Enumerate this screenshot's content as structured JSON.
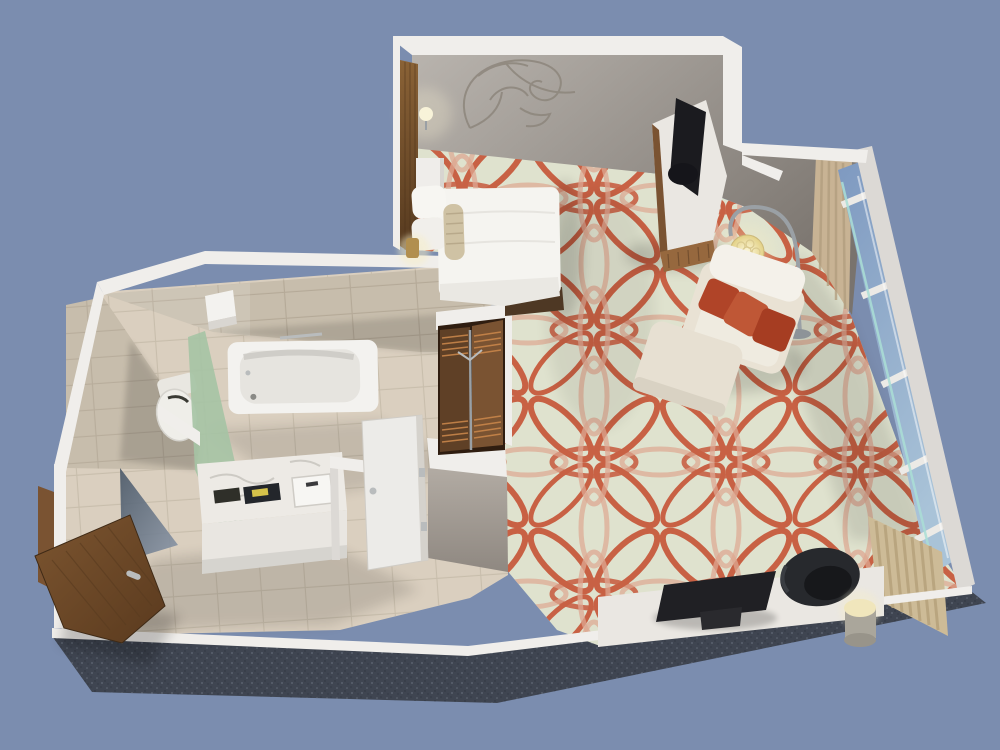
{
  "scene": {
    "type": "3d-room-render",
    "description": "Isometric cutaway 3D rendering of a hotel guest room floor plan on a plain blue background",
    "rooms": {
      "bedroom": {
        "objects": [
          "wall-art-swirl",
          "king-bed",
          "pillows",
          "bolster-cushion",
          "headboard-panel",
          "wall-sconce",
          "nightstand",
          "table-lamp-brass",
          "tv-console",
          "flat-screen-tv",
          "arc-floor-lamp",
          "armchair",
          "throw-pillows",
          "ottoman",
          "patterned-carpet",
          "work-desk",
          "desktop-monitor",
          "office-chair",
          "cylinder-table-lamp",
          "curtain",
          "floor-to-ceiling-windows",
          "vertical-blinds"
        ]
      },
      "bathroom": {
        "objects": [
          "tile-walls",
          "tile-floor",
          "bathtub",
          "towel-bar",
          "towel-shelf",
          "shower-glass-panel",
          "shower-head",
          "toilet",
          "wc-nook",
          "vanity-counter",
          "sink",
          "faucet",
          "amenity-trays",
          "closet",
          "louvered-doors",
          "bathroom-door-white",
          "entry-door-wood",
          "door-frame",
          "entry-mirror"
        ]
      },
      "structure": {
        "objects": [
          "exterior-white-walls",
          "foundation-slab",
          "sky-background"
        ]
      }
    }
  },
  "colors": {
    "background": "#7b8daf",
    "foundation": "#3f4551",
    "foundation_speck_light": "#69727f",
    "foundation_speck_dark": "#2b3039",
    "wall_white": "#f0eeeb",
    "wall_white_shade": "#dcd9d5",
    "wall_face_light": "#b9b4ae",
    "wall_face_dark": "#79736d",
    "wall_face_mid": "#a49d96",
    "art_stroke": "#8d867c",
    "carpet_base": "#dfe2ce",
    "carpet_primary": "#c75a3d",
    "carpet_secondary": "#dda48e",
    "tile_wall": "#c7bdac",
    "tile_wall_line": "#b3a896",
    "tile_floor": "#dacfbf",
    "tile_floor_line": "#c6bba9",
    "wood_dark": "#5f4026",
    "wood_mid": "#7a5332",
    "wood_light": "#96683e",
    "closet_interior": "#2f1d10",
    "louver_slat": "#c8854a",
    "glass_green": "#a5c3a4",
    "glass_blue_deep": "#7e99c0",
    "glass_blue_light": "#a9c3d8",
    "glass_teal": "#abdfd6",
    "curtain": "#c8b394",
    "curtain_fold": "#b29d7e",
    "blinds": "#cdbb97",
    "blinds_line": "#b7a37d",
    "fixture_white": "#f3f2ef",
    "fixture_shadow": "#d9d6d1",
    "marble": "#edeae5",
    "marble_vein": "#c9c6c0",
    "rust_pillow_1": "#b04428",
    "rust_pillow_2": "#bf5736",
    "rust_pillow_3": "#a63d22",
    "chair_cream": "#e9e2d4",
    "cushion_white": "#f4f1ea",
    "tv_black": "#1b1b1f",
    "monitor_black": "#202024",
    "office_chair_black": "#27292d",
    "lamp_glow": "#f6eec6",
    "lamp_metal": "#9aa0a5",
    "brass": "#b18f4f",
    "desk_white": "#eae7e2",
    "silver": "#b9bcbd",
    "amenity_dark": "#2f2f29",
    "amenity_yellow": "#d5c24a",
    "bed_white": "#f5f4f0",
    "bolster": "#cfc2a4",
    "door_wood_light": "#7c5530",
    "door_wood_dark": "#5a3a1e",
    "mirror_dark": "#4a5868",
    "mirror_light": "#8b97a8"
  }
}
